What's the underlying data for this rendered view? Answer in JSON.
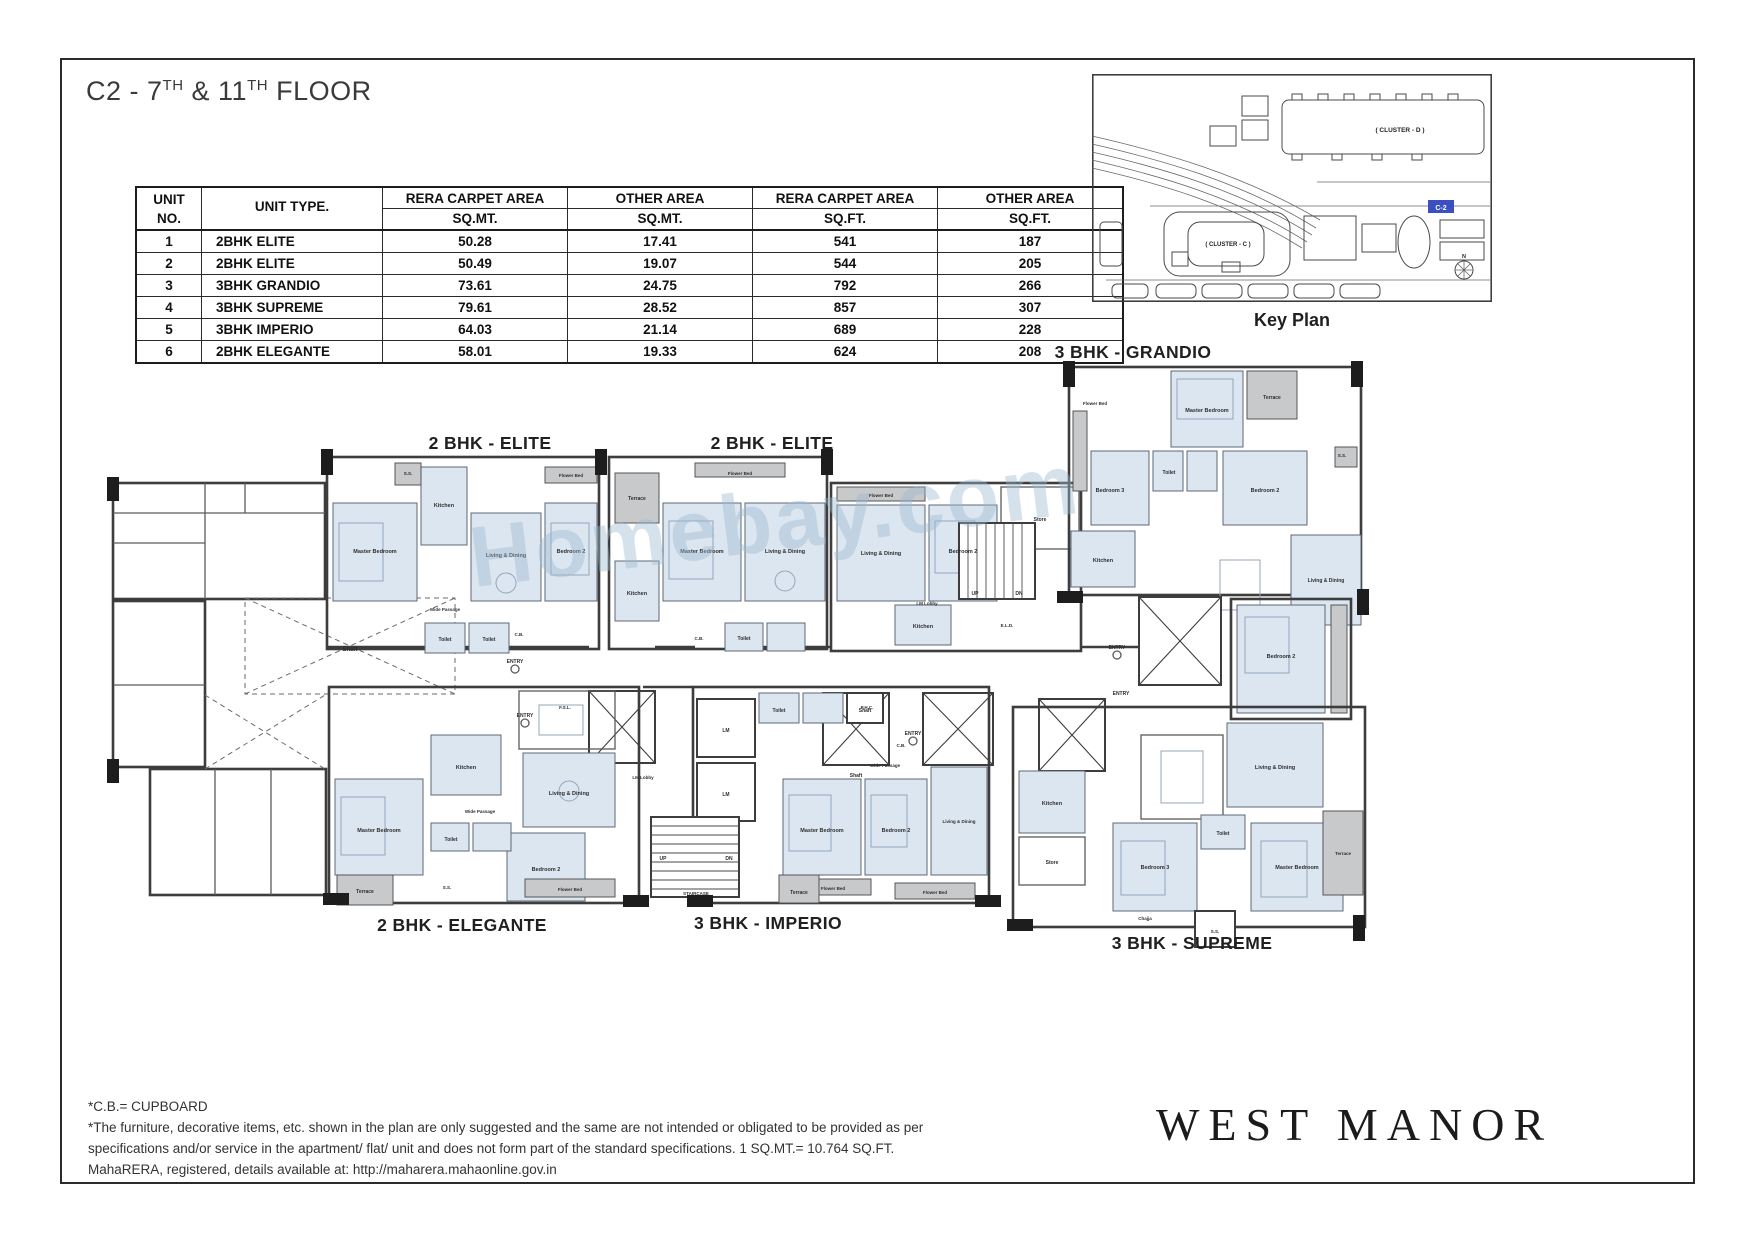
{
  "title": {
    "parts": [
      "C2 - 7",
      "TH",
      " & 11",
      "TH",
      " FLOOR"
    ]
  },
  "area_table": {
    "col_headers": [
      [
        "UNIT",
        "NO."
      ],
      [
        "UNIT TYPE.",
        ""
      ],
      [
        "RERA CARPET AREA",
        "SQ.MT."
      ],
      [
        "OTHER AREA",
        "SQ.MT."
      ],
      [
        "RERA CARPET AREA",
        "SQ.FT."
      ],
      [
        "OTHER AREA",
        "SQ.FT."
      ]
    ],
    "rows": [
      [
        "1",
        "2BHK ELITE",
        "50.28",
        "17.41",
        "541",
        "187"
      ],
      [
        "2",
        "2BHK ELITE",
        "50.49",
        "19.07",
        "544",
        "205"
      ],
      [
        "3",
        "3BHK GRANDIO",
        "73.61",
        "24.75",
        "792",
        "266"
      ],
      [
        "4",
        "3BHK SUPREME",
        "79.61",
        "28.52",
        "857",
        "307"
      ],
      [
        "5",
        "3BHK IMPERIO",
        "64.03",
        "21.14",
        "689",
        "228"
      ],
      [
        "6",
        "2BHK ELEGANTE",
        "58.01",
        "19.33",
        "624",
        "208"
      ]
    ]
  },
  "key_plan": {
    "caption": "Key Plan",
    "cluster_d_label": "( CLUSTER - D )",
    "cluster_c_label": "( CLUSTER - C )",
    "unit_marker": "C-2",
    "compass_label": "N",
    "marker_color": "#3a50c0"
  },
  "floor_plan": {
    "unit_labels": [
      {
        "text": "2 BHK - ELITE"
      },
      {
        "text": "2 BHK - ELITE"
      },
      {
        "text": "3 BHK - GRANDIO"
      },
      {
        "text": "2 BHK - ELEGANTE"
      },
      {
        "text": "3 BHK - IMPERIO"
      },
      {
        "text": "3 BHK - SUPREME"
      }
    ],
    "watermark": "Homebay.com",
    "room_labels": [
      {
        "t": "Shaft",
        "x": 255,
        "y": 296,
        "fs": 6
      },
      {
        "t": "Master Bedroom",
        "x": 280,
        "y": 198,
        "fs": 5.5
      },
      {
        "t": "Kitchen",
        "x": 349,
        "y": 152,
        "fs": 5.5
      },
      {
        "t": "Living & Dining",
        "x": 411,
        "y": 202,
        "fs": 5.5
      },
      {
        "t": "Bedroom 2",
        "x": 476,
        "y": 198,
        "fs": 5.5
      },
      {
        "t": "Toilet",
        "x": 350,
        "y": 286,
        "fs": 5
      },
      {
        "t": "Toilet",
        "x": 394,
        "y": 286,
        "fs": 5
      },
      {
        "t": "Wide Passage",
        "x": 350,
        "y": 256,
        "fs": 4.5
      },
      {
        "t": "Flower Bed",
        "x": 476,
        "y": 122,
        "fs": 4.5
      },
      {
        "t": "S.S.",
        "x": 313,
        "y": 120,
        "fs": 4.5
      },
      {
        "t": "C.B.",
        "x": 424,
        "y": 281,
        "fs": 4.5
      },
      {
        "t": "Terrace",
        "x": 542,
        "y": 145,
        "fs": 5
      },
      {
        "t": "Kitchen",
        "x": 542,
        "y": 240,
        "fs": 5.5
      },
      {
        "t": "Master Bedroom",
        "x": 607,
        "y": 198,
        "fs": 5.5
      },
      {
        "t": "Living & Dining",
        "x": 690,
        "y": 198,
        "fs": 5.5
      },
      {
        "t": "Flower Bed",
        "x": 645,
        "y": 120,
        "fs": 4.5
      },
      {
        "t": "Toilet",
        "x": 649,
        "y": 285,
        "fs": 5
      },
      {
        "t": "C.B.",
        "x": 604,
        "y": 285,
        "fs": 4.5
      },
      {
        "t": "Flower Bed",
        "x": 786,
        "y": 142,
        "fs": 4.5
      },
      {
        "t": "Living & Dining",
        "x": 786,
        "y": 200,
        "fs": 5.5
      },
      {
        "t": "Bedroom 2",
        "x": 868,
        "y": 198,
        "fs": 5.5
      },
      {
        "t": "Kitchen",
        "x": 828,
        "y": 273,
        "fs": 5.5
      },
      {
        "t": "Store",
        "x": 945,
        "y": 166,
        "fs": 5
      },
      {
        "t": "UP",
        "x": 880,
        "y": 240,
        "fs": 5
      },
      {
        "t": "DN",
        "x": 924,
        "y": 240,
        "fs": 5
      },
      {
        "t": "LM Lobby",
        "x": 832,
        "y": 250,
        "fs": 4.5
      },
      {
        "t": "E.L.D.",
        "x": 912,
        "y": 272,
        "fs": 4.5
      },
      {
        "t": "Terrace",
        "x": 1177,
        "y": 44,
        "fs": 5
      },
      {
        "t": "Master Bedroom",
        "x": 1112,
        "y": 57,
        "fs": 5.5
      },
      {
        "t": "Flower Bed",
        "x": 1000,
        "y": 50,
        "fs": 4.5
      },
      {
        "t": "Bedroom 3",
        "x": 1015,
        "y": 137,
        "fs": 5.5
      },
      {
        "t": "Bedroom 2",
        "x": 1170,
        "y": 137,
        "fs": 5.5
      },
      {
        "t": "Toilet",
        "x": 1074,
        "y": 119,
        "fs": 5
      },
      {
        "t": "Kitchen",
        "x": 1008,
        "y": 207,
        "fs": 5.5
      },
      {
        "t": "Living & Dining",
        "x": 1231,
        "y": 227,
        "fs": 5
      },
      {
        "t": "S.S.",
        "x": 1247,
        "y": 102,
        "fs": 4.5
      },
      {
        "t": "Bedroom 2",
        "x": 1186,
        "y": 303,
        "fs": 5.5
      },
      {
        "t": "Shaft",
        "x": 761,
        "y": 422,
        "fs": 5
      },
      {
        "t": "LM",
        "x": 631,
        "y": 377,
        "fs": 5
      },
      {
        "t": "LM",
        "x": 631,
        "y": 441,
        "fs": 5
      },
      {
        "t": "LM Lobby",
        "x": 548,
        "y": 424,
        "fs": 4.5
      },
      {
        "t": "F.S.L.",
        "x": 470,
        "y": 354,
        "fs": 4.5
      },
      {
        "t": "P.H.C.",
        "x": 772,
        "y": 354,
        "fs": 4.5
      },
      {
        "t": "ENTRY",
        "x": 420,
        "y": 308,
        "fs": 5
      },
      {
        "t": "ENTRY",
        "x": 430,
        "y": 362,
        "fs": 5
      },
      {
        "t": "ENTRY",
        "x": 818,
        "y": 380,
        "fs": 5
      },
      {
        "t": "ENTRY",
        "x": 1022,
        "y": 294,
        "fs": 5
      },
      {
        "t": "ENTRY",
        "x": 1026,
        "y": 340,
        "fs": 5
      },
      {
        "t": "Master Bedroom",
        "x": 284,
        "y": 477,
        "fs": 5.5
      },
      {
        "t": "Terrace",
        "x": 270,
        "y": 538,
        "fs": 5
      },
      {
        "t": "Bedroom 2",
        "x": 451,
        "y": 516,
        "fs": 5.5
      },
      {
        "t": "Living & Dining",
        "x": 474,
        "y": 440,
        "fs": 5.5
      },
      {
        "t": "Kitchen",
        "x": 371,
        "y": 414,
        "fs": 5.5
      },
      {
        "t": "Toilet",
        "x": 356,
        "y": 486,
        "fs": 5
      },
      {
        "t": "Wide Passage",
        "x": 385,
        "y": 458,
        "fs": 4.5
      },
      {
        "t": "Flower Bed",
        "x": 475,
        "y": 536,
        "fs": 4.5
      },
      {
        "t": "S.S.",
        "x": 352,
        "y": 534,
        "fs": 4.5
      },
      {
        "t": "Toilet",
        "x": 684,
        "y": 357,
        "fs": 5
      },
      {
        "t": "Shaft",
        "x": 770,
        "y": 357,
        "fs": 5
      },
      {
        "t": "C.B.",
        "x": 806,
        "y": 392,
        "fs": 4.5
      },
      {
        "t": "Master Bedroom",
        "x": 727,
        "y": 477,
        "fs": 5.5
      },
      {
        "t": "Bedroom 2",
        "x": 801,
        "y": 477,
        "fs": 5.5
      },
      {
        "t": "Living & Dining",
        "x": 864,
        "y": 468,
        "fs": 4.5
      },
      {
        "t": "Wide Passage",
        "x": 790,
        "y": 412,
        "fs": 4.5
      },
      {
        "t": "Flower Bed",
        "x": 738,
        "y": 535,
        "fs": 4.5
      },
      {
        "t": "Flower Bed",
        "x": 840,
        "y": 539,
        "fs": 4.5
      },
      {
        "t": "Terrace",
        "x": 704,
        "y": 539,
        "fs": 5
      },
      {
        "t": "STAIRCASE",
        "x": 601,
        "y": 540,
        "fs": 4.5
      },
      {
        "t": "UP",
        "x": 568,
        "y": 505,
        "fs": 5
      },
      {
        "t": "DN",
        "x": 634,
        "y": 505,
        "fs": 5
      },
      {
        "t": "Kitchen",
        "x": 957,
        "y": 450,
        "fs": 5.5
      },
      {
        "t": "Store",
        "x": 957,
        "y": 509,
        "fs": 5
      },
      {
        "t": "Bedroom 3",
        "x": 1060,
        "y": 514,
        "fs": 5.5
      },
      {
        "t": "Master Bedroom",
        "x": 1202,
        "y": 514,
        "fs": 5.5
      },
      {
        "t": "Living & Dining",
        "x": 1180,
        "y": 414,
        "fs": 5.5
      },
      {
        "t": "Toilet",
        "x": 1128,
        "y": 480,
        "fs": 5
      },
      {
        "t": "Terrace",
        "x": 1248,
        "y": 500,
        "fs": 4.5
      },
      {
        "t": "S.S.",
        "x": 1120,
        "y": 578,
        "fs": 4.5
      },
      {
        "t": "Chajja",
        "x": 1050,
        "y": 565,
        "fs": 4.5
      }
    ]
  },
  "notes": {
    "lines": [
      "*C.B.= CUPBOARD",
      "*The furniture, decorative items, etc. shown in the plan are only suggested and the same are not intended or obligated to be provided as per",
      "specifications and/or service in the apartment/ flat/ unit and does not form part of the standard specifications. 1 SQ.MT.= 10.764 SQ.FT.",
      "MahaRERA, registered, details available at: http://maharera.mahaonline.gov.in"
    ]
  },
  "brand": {
    "logo": "WEST MANOR"
  }
}
